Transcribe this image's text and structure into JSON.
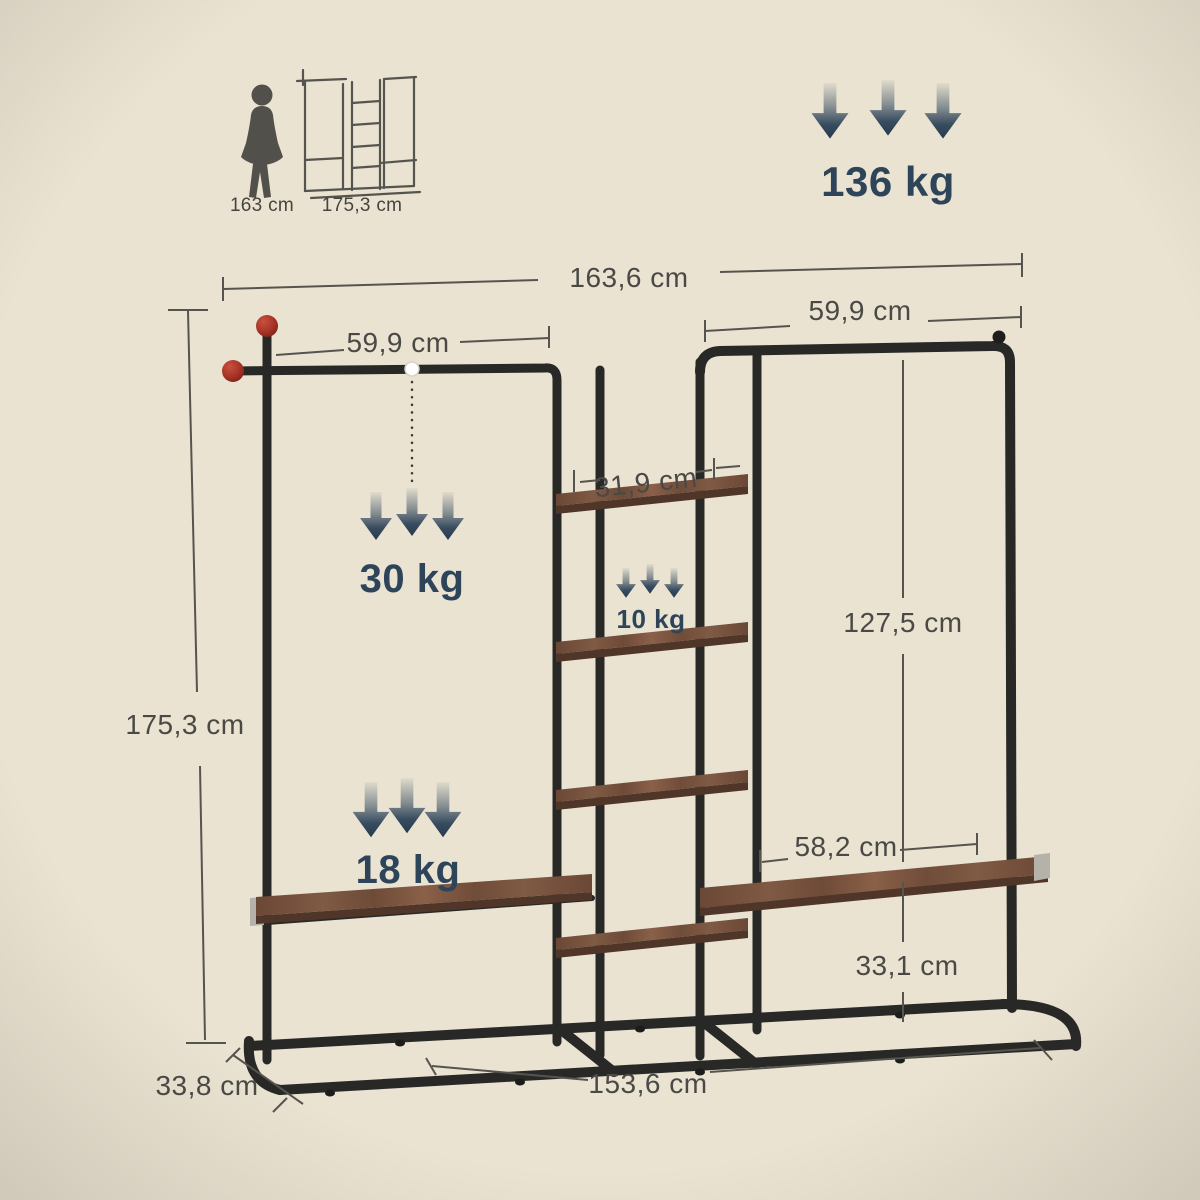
{
  "title": "Garment rack dimension diagram",
  "colors": {
    "background": "#eae3d2",
    "metal_frame": "#282826",
    "wood_shelf": "#7a5540",
    "navy_accent": "#2e4459",
    "dimension_text": "#4a4945",
    "red_end_cap": "#b03a2e",
    "silver_bracket": "#b5b2aa"
  },
  "reference": {
    "person_height": "163 cm",
    "rack_height": "175,3 cm"
  },
  "max_load": {
    "total": "136 kg"
  },
  "loads": {
    "rail": "30 kg",
    "shelf": "10 kg",
    "bottom_shelf": "18 kg"
  },
  "dims": {
    "total_width": "163,6 cm",
    "left_rail_width": "59,9 cm",
    "right_rail_width": "59,9 cm",
    "middle_shelf_width": "31,9 cm",
    "right_inner_height": "127,5 cm",
    "total_height": "175,3 cm",
    "right_shelf_width": "58,2 cm",
    "right_shelf_ground_height": "33,1 cm",
    "depth": "33,8 cm",
    "base_width": "153,6 cm"
  }
}
